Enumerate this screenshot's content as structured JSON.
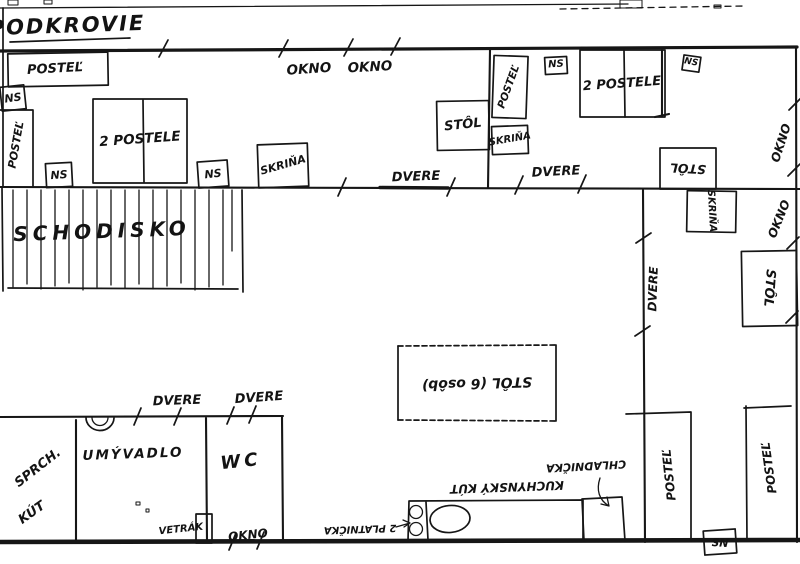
{
  "floorplan": {
    "title": "PODKROVIE",
    "ink_color": "#161616",
    "paper_color": "#ffffff",
    "labels": {
      "postel": "POSTEĽ",
      "dve_postele": "2 POSTELE",
      "ns": "NS",
      "stol": "STÔL",
      "stol_6_osob": "STÔL (6 osôb)",
      "skrina": "SKRIŇA",
      "dvere": "DVERE",
      "okno": "OKNO",
      "schodisko": "SCHODISKO",
      "sprch": "SPRCH.",
      "kut": "KÚT",
      "umyvadlo": "UMÝVADLO",
      "wc": "WC",
      "vetrak": "VETRÁK",
      "kuchynsky_kut": "KUCHYNSKÝ KÚT",
      "chladnicka": "CHLADNIČKA",
      "dve_platnicky": "2 PLATNIČKA"
    }
  }
}
